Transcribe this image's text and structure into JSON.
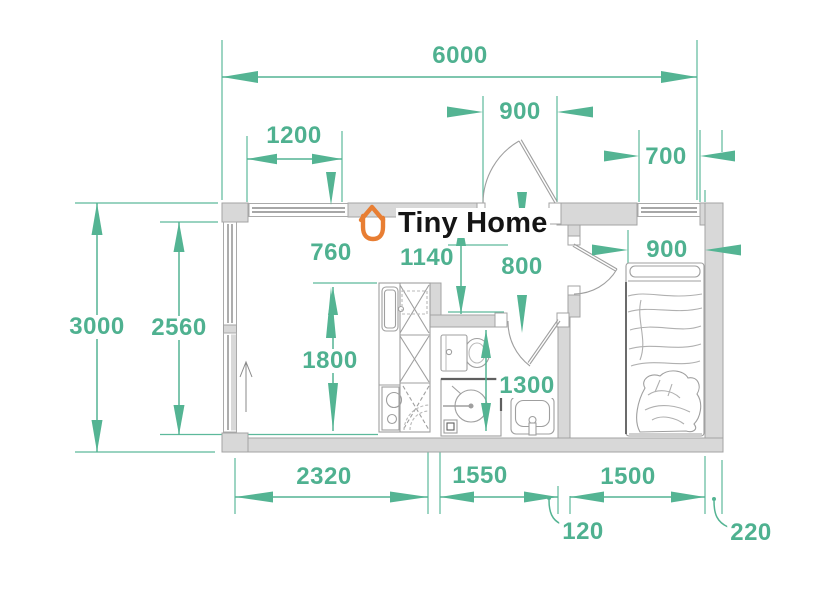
{
  "logo": {
    "brand_name": "Tiny Home"
  },
  "colors": {
    "dimension_accent": "#4FB190",
    "logo_orange": "#E87E33",
    "wall_fill": "#D8D8D8",
    "wall_stroke": "#A3A3A3",
    "furniture_stroke": "#9F9F9F",
    "title_text": "#151515"
  },
  "floor_plan": {
    "units": "mm",
    "dimension_labels": [
      {
        "id": "overall-width",
        "value": "6000",
        "x": 460,
        "y": 56
      },
      {
        "id": "living-window-width",
        "value": "1200",
        "x": 294,
        "y": 136
      },
      {
        "id": "entry-door-width",
        "value": "900",
        "x": 520,
        "y": 112
      },
      {
        "id": "bedroom-window-width",
        "value": "700",
        "x": 666,
        "y": 157
      },
      {
        "id": "passage-width",
        "value": "760",
        "x": 331,
        "y": 253
      },
      {
        "id": "hall-depth",
        "value": "1140",
        "x": 427,
        "y": 258
      },
      {
        "id": "hall-width",
        "value": "800",
        "x": 522,
        "y": 267
      },
      {
        "id": "bed-width",
        "value": "900",
        "x": 667,
        "y": 250
      },
      {
        "id": "overall-depth",
        "value": "3000",
        "x": 97,
        "y": 327
      },
      {
        "id": "interior-depth",
        "value": "2560",
        "x": 179,
        "y": 328
      },
      {
        "id": "kitchen-run-length",
        "value": "1800",
        "x": 330,
        "y": 361
      },
      {
        "id": "bathroom-depth",
        "value": "1300",
        "x": 527,
        "y": 386
      },
      {
        "id": "living-room-width",
        "value": "2320",
        "x": 324,
        "y": 477
      },
      {
        "id": "bathroom-width",
        "value": "1550",
        "x": 480,
        "y": 476
      },
      {
        "id": "bedroom-width",
        "value": "1500",
        "x": 628,
        "y": 477
      },
      {
        "id": "partition-thickness",
        "value": "120",
        "x": 583,
        "y": 532
      },
      {
        "id": "wall-thickness",
        "value": "220",
        "x": 751,
        "y": 533
      }
    ]
  }
}
